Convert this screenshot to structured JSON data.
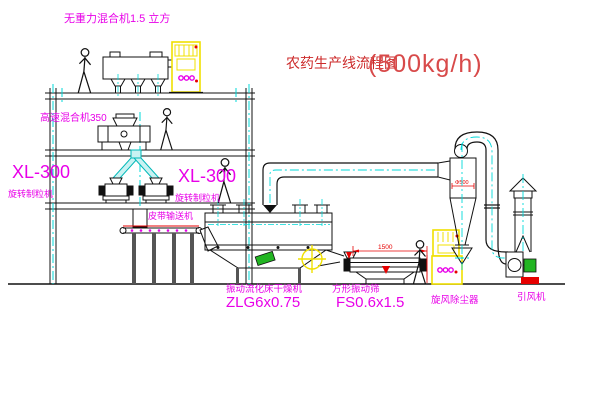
{
  "title": {
    "main": "农药生产线流程图",
    "capacity": "(500kg/h)"
  },
  "equipment_labels": {
    "gravity_mixer": "无重力混合机1.5 立方",
    "high_speed_mixer": "高速混合机350",
    "granulator_left_model": "XL-300",
    "granulator_left_name": "旋转制粒机",
    "granulator_right_model": "XL-300",
    "granulator_right_name": "旋转制粒机",
    "belt_conveyor": "皮带输送机",
    "fluid_bed_dryer_name": "振动流化床干燥机",
    "fluid_bed_dryer_model": "ZLG6x0.75",
    "vibrating_screen_name": "方形振动筛",
    "vibrating_screen_model": "FS0.6x1.5",
    "cyclone": "旋风除尘器",
    "induced_draft_fan": "引风机"
  },
  "dimensions": {
    "screen_length": "1500",
    "cyclone_diameter": "Φ500"
  },
  "colors": {
    "line": "#111111",
    "cyan": "#00d9d9",
    "magenta": "#e800e8",
    "red": "#e60000",
    "yellow": "#f0e000",
    "green": "#22b522",
    "title_red": "#cc2a2a"
  }
}
